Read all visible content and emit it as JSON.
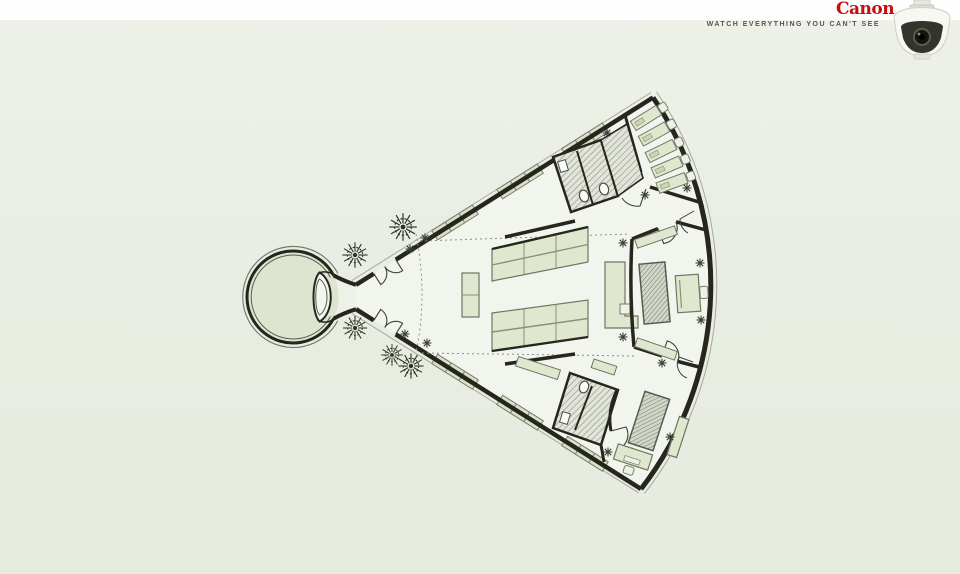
{
  "ad": {
    "brand_logo": "Canon",
    "tagline": "WATCH EVERYTHING YOU CAN'T SEE"
  },
  "icons": {
    "camera": "dome-security-camera",
    "floorplan": "eye-shaped-office-floorplan",
    "tree": "tree-starburst",
    "plant": "indoor-plant-asterisk"
  },
  "floorplan_elements": {
    "trees": 5,
    "indoor_plants": 14,
    "desk_rows_top_right": 5,
    "central_desk_banks": 2,
    "restrooms": 2
  },
  "colors": {
    "canon_red": "#c60d0e",
    "tagline_gray": "#55564b",
    "top_band": "#fefefe",
    "background": "#e9eee4",
    "plan_interior": "#f2f5ee",
    "walls": "#26261f",
    "furniture_green": "#dfe7cf",
    "window_green": "#d9e2c6",
    "plaza_green": "#dde5d1"
  }
}
